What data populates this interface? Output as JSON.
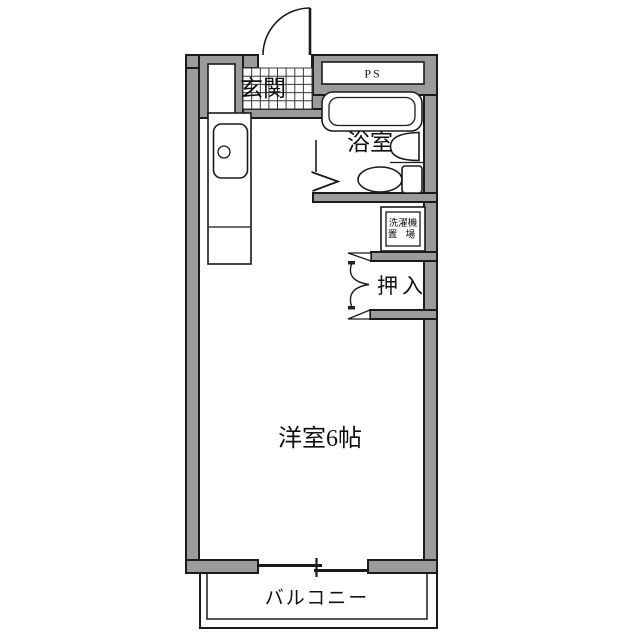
{
  "plan": {
    "labels": {
      "entrance": "玄関",
      "pipe_space": "PS",
      "bathroom": "浴室",
      "laundry_line1": "洗濯機",
      "laundry_line2": "置 場",
      "closet": "押入",
      "western_room": "洋室6帖",
      "balcony": "バルコニー"
    },
    "colors": {
      "wall_fill": "#9b9b9b",
      "outline": "#1b1b1b",
      "background": "#ffffff"
    }
  }
}
